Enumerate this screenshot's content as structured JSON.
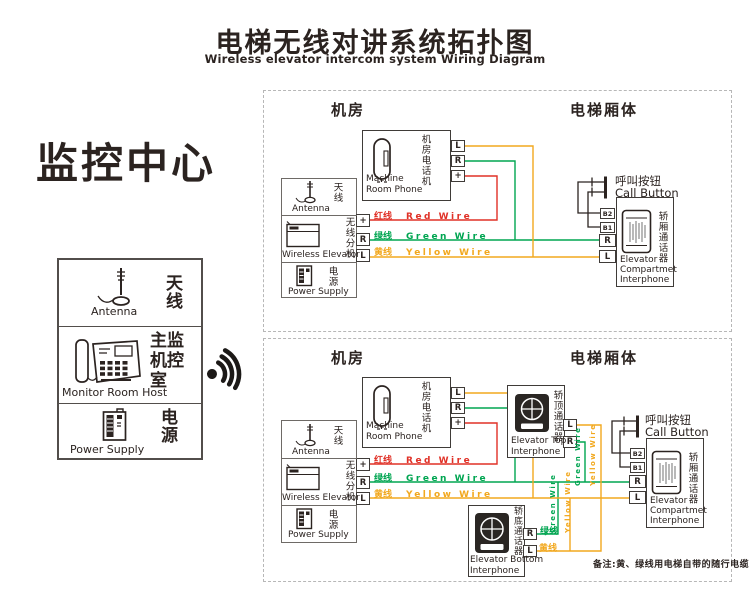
{
  "colors": {
    "red": "#e03127",
    "green": "#00a551",
    "yellow": "#f2a81e",
    "ink": "#2b2320"
  },
  "title": {
    "zh": "电梯无线对讲系统拓扑图",
    "en": "Wireless elevator intercom system Wiring Diagram"
  },
  "monitor": {
    "heading": "监控中心",
    "antenna_zh": "天线",
    "antenna_en": "Antenna",
    "host_zh": "主监机控室",
    "host_en": "Monitor Room Host",
    "power_zh": "电源",
    "power_en": "Power Supply"
  },
  "headers": {
    "machine_room": "机房",
    "elevator_car": "电梯厢体"
  },
  "phone": {
    "zh": "机房电话机",
    "en1": "Machine",
    "en2": "Room Phone"
  },
  "unit": {
    "antenna_zh": "天线",
    "antenna_en": "Antenna",
    "unit_zh": "无线分机",
    "unit_en": "Wireless Elevator",
    "power_zh": "电源",
    "power_en": "Power Supply"
  },
  "wires": {
    "red_zh": "红线",
    "red_en": "Red Wire",
    "green_zh": "绿线",
    "green_en": "Green Wire",
    "yellow_zh": "黄线",
    "yellow_en": "Yellow Wire"
  },
  "terminals": {
    "l": "L",
    "r": "R",
    "plus": "+",
    "b1": "B1",
    "b2": "B2"
  },
  "call": {
    "zh": "呼叫按钮",
    "en": "Call Button"
  },
  "compartment": {
    "zh": "轿厢通话器",
    "en1": "Elevator",
    "en2": "Compartmet",
    "en3": "Interphone"
  },
  "top_unit": {
    "zh": "轿顶通话器",
    "en1": "Elevator Top",
    "en2": "Interphone"
  },
  "bottom_unit": {
    "zh": "轿底通话器",
    "en1": "Elevator Bottom",
    "en2": "Interphone"
  },
  "note": "备注:黄、绿线用电梯自带的随行电缆"
}
